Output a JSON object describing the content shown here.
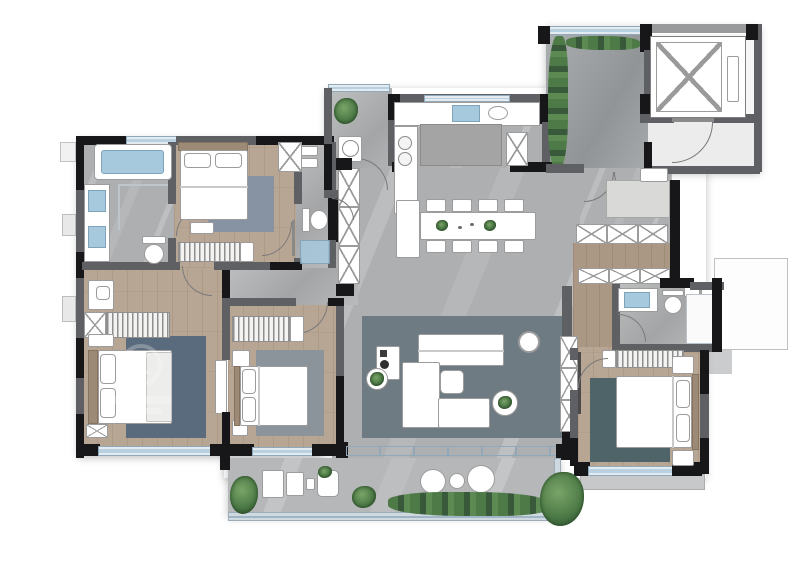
{
  "image": {
    "kind": "residential floor plan rendering",
    "view": "top-down furnished",
    "text_labels_visible": false
  },
  "watermark": {
    "present": true,
    "legible": false
  },
  "palette": {
    "bg": "#ffffff",
    "wall_dark": "#17171a",
    "wall_mid": "#5f6063",
    "wall_light": "#989a9c",
    "tile": "#adafb0",
    "tile_dark": "#9da1a3",
    "wood": "#b8a694",
    "wood_dark": "#ab9884",
    "balcony": "#b5b7b9",
    "rug_living": "#6f7b83",
    "rug_blue": "#5a6b7d",
    "rug_teal": "#4e6468",
    "rug_gray": "#8c949b",
    "rug_slate": "#8793a2",
    "window": "#b9d0e0",
    "water": "#a7c9de",
    "plant_green": "#4c7a46",
    "furniture": "#ffffff",
    "furniture_line": "#9c9c9c"
  },
  "rooms": [
    {
      "id": "master-bathroom",
      "features": [
        "bathtub",
        "double-vanity",
        "toilet",
        "shower-screen",
        "window"
      ]
    },
    {
      "id": "master-bedroom",
      "features": [
        "double-bed",
        "rug",
        "bench",
        "nightstand",
        "wardrobe-hanging",
        "closet"
      ]
    },
    {
      "id": "second-bathroom",
      "features": [
        "vanity",
        "toilet",
        "shower"
      ]
    },
    {
      "id": "laundry-balcony",
      "features": [
        "washing-machine",
        "plant",
        "window"
      ]
    },
    {
      "id": "kitchen",
      "features": [
        "counter",
        "sink",
        "cooktop",
        "island",
        "fridge-cabinet"
      ]
    },
    {
      "id": "entry-foyer",
      "features": [
        "planting-bed",
        "double-door",
        "entry-door"
      ]
    },
    {
      "id": "elevator-lobby",
      "features": [
        "elevator-shaft",
        "lobby-door"
      ]
    },
    {
      "id": "dining-area",
      "features": [
        "dining-table",
        "eight-chairs",
        "buffet",
        "table-plants"
      ]
    },
    {
      "id": "living-room",
      "features": [
        "sectional-sofa",
        "coffee-table",
        "side-tables",
        "plants",
        "area-rug",
        "tv-console"
      ]
    },
    {
      "id": "storage-hall",
      "features": [
        "x-cabinet-rows",
        "tall-cabinet"
      ]
    },
    {
      "id": "third-bathroom",
      "features": [
        "vanity",
        "toilet",
        "shower-room"
      ]
    },
    {
      "id": "bedroom-two",
      "features": [
        "double-bed",
        "rug",
        "nightstands",
        "wardrobe-hanging",
        "window"
      ]
    },
    {
      "id": "bedroom-three",
      "features": [
        "double-bed",
        "rug",
        "nightstands",
        "wardrobe-hanging",
        "window"
      ]
    },
    {
      "id": "bedroom-four",
      "features": [
        "double-bed",
        "rug",
        "desk",
        "wardrobe-hanging",
        "window"
      ]
    },
    {
      "id": "south-balcony",
      "features": [
        "lounge-chair",
        "armchairs",
        "round-table",
        "planters",
        "railing"
      ]
    },
    {
      "id": "equipment-platform",
      "features": [
        "ac-units"
      ]
    }
  ]
}
